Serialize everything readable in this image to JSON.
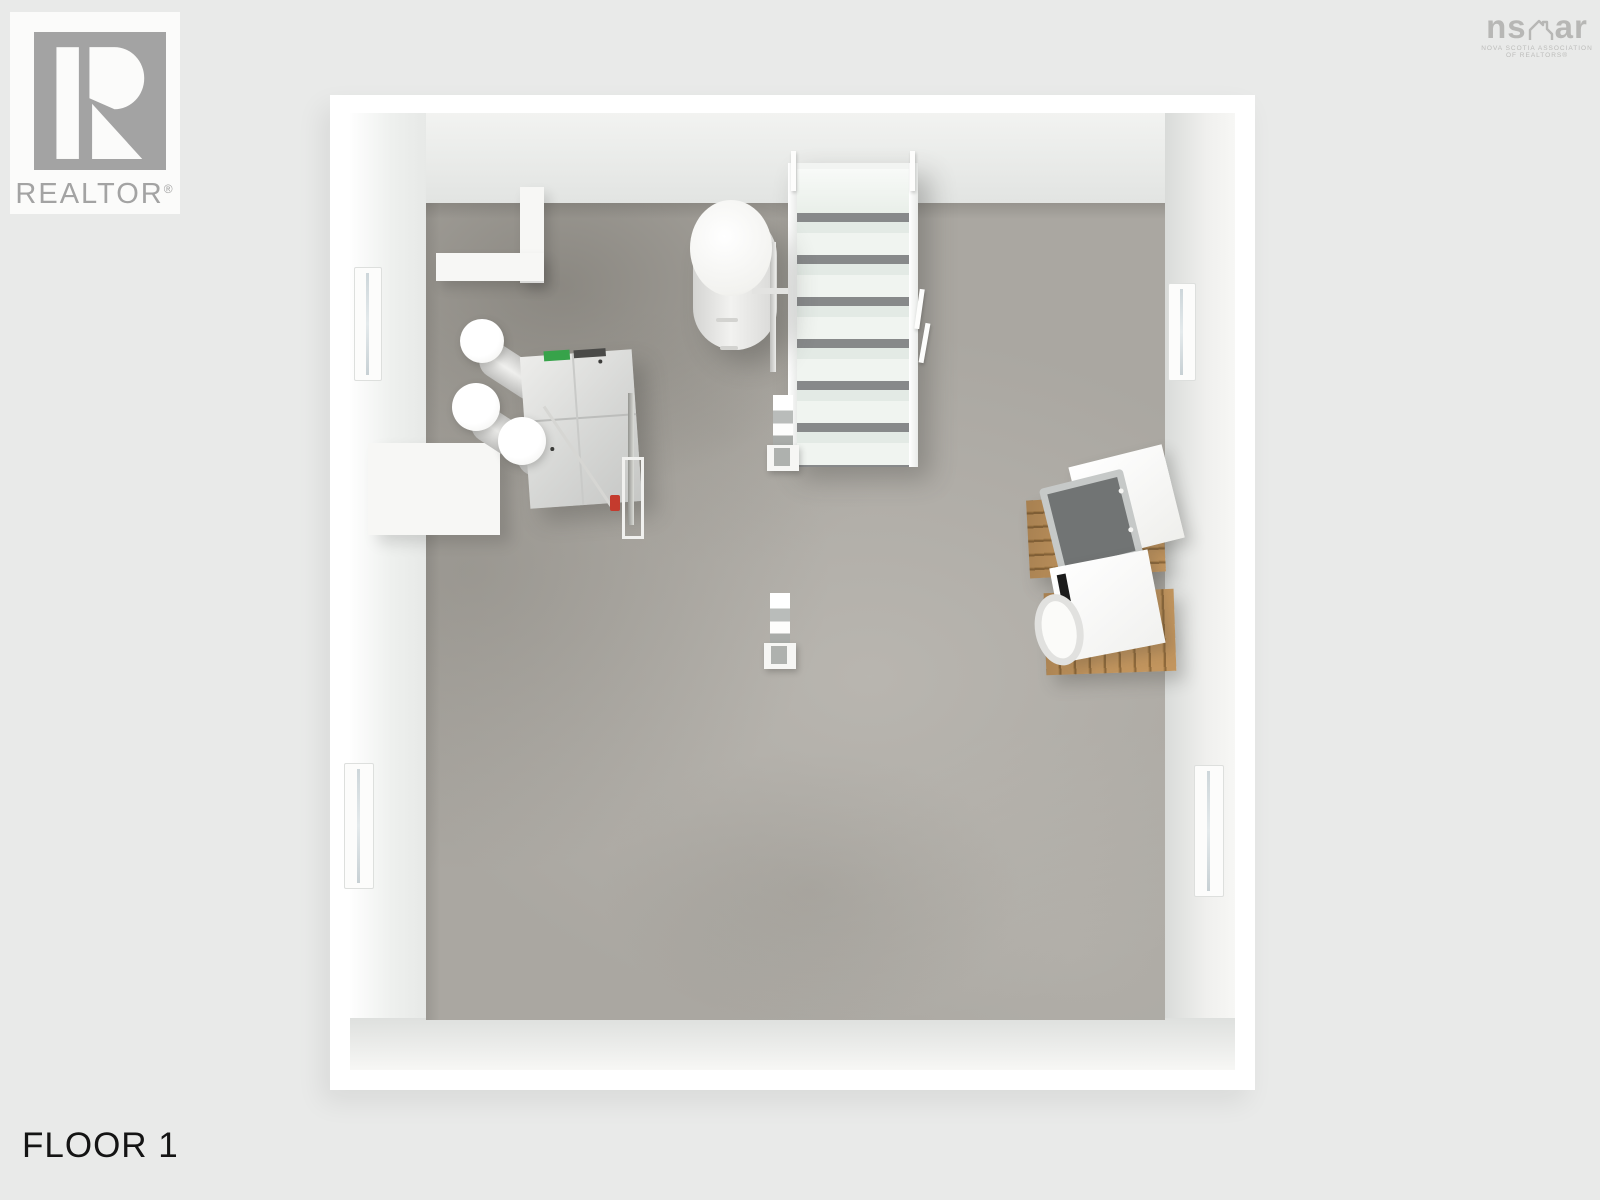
{
  "branding": {
    "realtor": {
      "label": "REALTOR",
      "reg": "®"
    },
    "nsar": {
      "left": "ns",
      "right": "ar",
      "line1": "NOVA SCOTIA ASSOCIATION",
      "line2": "OF REALTORS®"
    }
  },
  "floor_label": "FLOOR 1",
  "scene": {
    "view": "3d-top-down-floor-plan-render",
    "room": "unfinished basement with concrete floor and white walls",
    "objects": [
      {
        "name": "staircase",
        "steps": 7,
        "railing_posts": 4
      },
      {
        "name": "water-heater-tank"
      },
      {
        "name": "hrv-ventilation-unit",
        "duct_count": 3
      },
      {
        "name": "support-post",
        "count": 2
      },
      {
        "name": "dryer-on-wood-pallet"
      },
      {
        "name": "washer-on-wood-pallet"
      },
      {
        "name": "window",
        "count": 4
      },
      {
        "name": "alcove-wall-stub"
      },
      {
        "name": "foundation-ledge"
      }
    ],
    "colors": {
      "background": "#e9eae9",
      "wall": "#ffffff",
      "floor_concrete": "#aaa7a1",
      "wood_pallet": "#bc9058",
      "appliance_screen": "#717474",
      "accent_green": "#37a34a",
      "accent_red": "#c43b2e",
      "logo_gray": "#a3a3a3",
      "text_black": "#141414"
    }
  }
}
